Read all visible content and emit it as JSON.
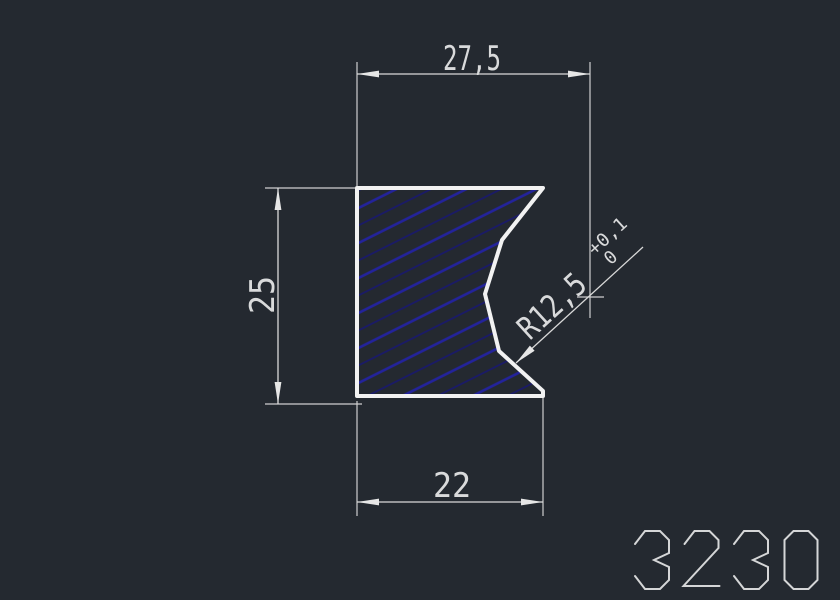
{
  "drawing": {
    "part_number": "3230",
    "dimensions": {
      "top_width": "27,5",
      "height": "25",
      "bottom_width": "22",
      "radius": "R12,5",
      "radius_tol_upper": "+0,1",
      "radius_tol_lower": "0"
    },
    "colors": {
      "background": "#242930",
      "outline": "#f2f2f2",
      "dimension_lines": "#d9d9d9",
      "dimension_text": "#d9dadb",
      "hatch_primary": "#23239c",
      "hatch_secondary": "#1a1a6a",
      "logo": "#d5d6d7"
    }
  }
}
